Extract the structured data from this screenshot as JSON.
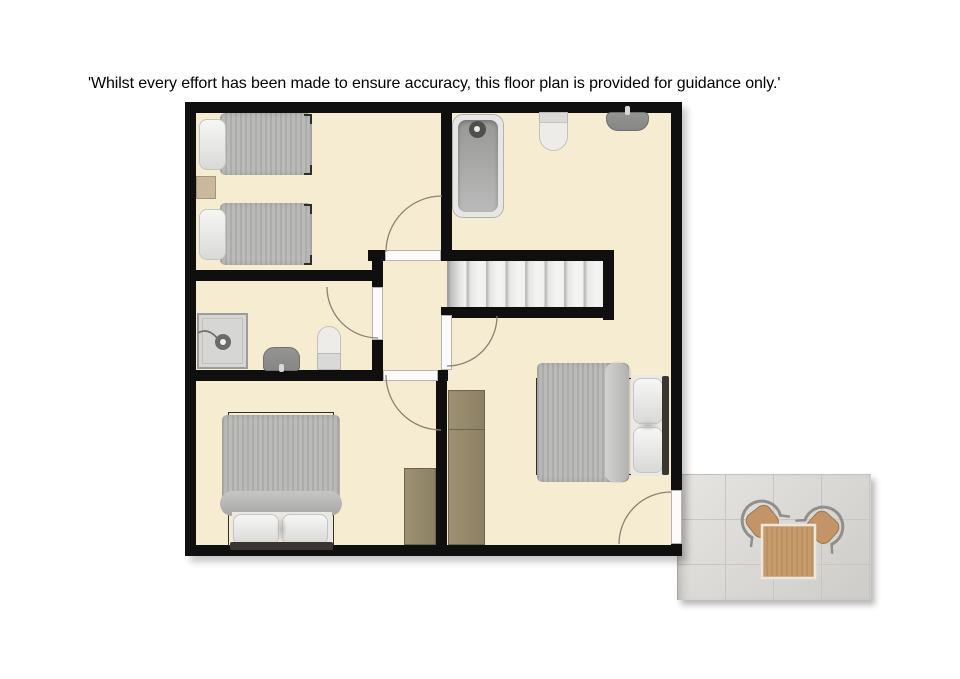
{
  "disclaimer": "'Whilst every effort has been made to ensure accuracy, this floor plan is provided for guidance only.'",
  "floorplan": {
    "rooms": [
      {
        "name": "twin bedroom",
        "position": "top-left"
      },
      {
        "name": "bathroom",
        "position": "top-right"
      },
      {
        "name": "shower room",
        "position": "middle-left"
      },
      {
        "name": "landing",
        "position": "centre"
      },
      {
        "name": "double bedroom",
        "position": "bottom-left"
      },
      {
        "name": "double bedroom",
        "position": "bottom-right"
      },
      {
        "name": "patio terrace",
        "position": "outside-bottom-right"
      }
    ],
    "fixtures": [
      "single-bed",
      "single-bed",
      "bedside-table",
      "bathtub",
      "toilet",
      "basin",
      "staircase",
      "shower-enclosure",
      "basin",
      "toilet",
      "double-bed",
      "wardrobe",
      "double-bed",
      "wardrobe",
      "garden-table",
      "garden-chair",
      "garden-chair"
    ],
    "doors": 5,
    "colors": {
      "floor": "#f6ecd2",
      "wall": "#0f0f0f",
      "furniture_gray": "#b5b5b3",
      "wood": "#8c8064",
      "patio_tile": "#d9d7d3",
      "table_wood": "#c79c6d"
    }
  }
}
